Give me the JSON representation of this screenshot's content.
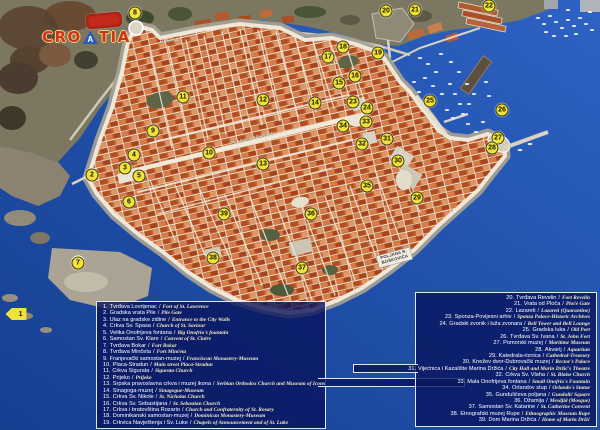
{
  "logo": {
    "text_pre": "CRO",
    "text_a": "A",
    "text_post": "TIA"
  },
  "ui": {
    "separator": "/"
  },
  "colors": {
    "sea_blue": "#2152ac",
    "roof_terracotta": "#c2602e",
    "marker_yellow": "#f0e13c",
    "legend_navy": "#09145e",
    "legend_english_text": "#f2e8c0",
    "wall_white": "#efe8d8"
  },
  "map": {
    "labels": [
      {
        "text": "PELINE",
        "x": 160,
        "y": 40,
        "rot": -6
      },
      {
        "text": "PLACA STRADUN",
        "x": 230,
        "y": 142,
        "rot": -13
      },
      {
        "text": "POLJANA R. BOŠKOVIĆA",
        "x": 378,
        "y": 256,
        "rot": -15,
        "cls": "sign"
      }
    ],
    "markers": [
      {
        "n": "1",
        "x": 16,
        "y": 314,
        "cls": "arrow"
      },
      {
        "n": "2",
        "x": 92,
        "y": 175
      },
      {
        "n": "3",
        "x": 125,
        "y": 168
      },
      {
        "n": "4",
        "x": 134,
        "y": 155
      },
      {
        "n": "5",
        "x": 139,
        "y": 176
      },
      {
        "n": "6",
        "x": 129,
        "y": 202
      },
      {
        "n": "7",
        "x": 78,
        "y": 263
      },
      {
        "n": "8",
        "x": 135,
        "y": 13
      },
      {
        "n": "9",
        "x": 153,
        "y": 131
      },
      {
        "n": "10",
        "x": 209,
        "y": 153
      },
      {
        "n": "11",
        "x": 183,
        "y": 97
      },
      {
        "n": "12",
        "x": 263,
        "y": 100
      },
      {
        "n": "13",
        "x": 263,
        "y": 164
      },
      {
        "n": "14",
        "x": 315,
        "y": 103
      },
      {
        "n": "15",
        "x": 339,
        "y": 83
      },
      {
        "n": "16",
        "x": 355,
        "y": 76
      },
      {
        "n": "17",
        "x": 328,
        "y": 57
      },
      {
        "n": "18",
        "x": 343,
        "y": 47
      },
      {
        "n": "19",
        "x": 378,
        "y": 53
      },
      {
        "n": "20",
        "x": 386,
        "y": 11
      },
      {
        "n": "21",
        "x": 415,
        "y": 10
      },
      {
        "n": "22",
        "x": 489,
        "y": 6
      },
      {
        "n": "23",
        "x": 353,
        "y": 102
      },
      {
        "n": "24",
        "x": 367,
        "y": 108
      },
      {
        "n": "25",
        "x": 430,
        "y": 101
      },
      {
        "n": "26",
        "x": 502,
        "y": 110
      },
      {
        "n": "27",
        "x": 498,
        "y": 138
      },
      {
        "n": "28",
        "x": 492,
        "y": 148
      },
      {
        "n": "29",
        "x": 417,
        "y": 198
      },
      {
        "n": "30",
        "x": 398,
        "y": 161
      },
      {
        "n": "31",
        "x": 387,
        "y": 139
      },
      {
        "n": "32",
        "x": 362,
        "y": 144
      },
      {
        "n": "33",
        "x": 366,
        "y": 122
      },
      {
        "n": "34",
        "x": 343,
        "y": 126
      },
      {
        "n": "35",
        "x": 367,
        "y": 186
      },
      {
        "n": "36",
        "x": 311,
        "y": 214
      },
      {
        "n": "37",
        "x": 302,
        "y": 268
      },
      {
        "n": "38",
        "x": 213,
        "y": 258
      },
      {
        "n": "39",
        "x": 224,
        "y": 214
      }
    ]
  },
  "legend_left": {
    "items": [
      {
        "num": "1.",
        "hr": "Tvrđava Lovrijenac",
        "en": "Fort of St. Lawrence"
      },
      {
        "num": "2.",
        "hr": "Gradska vrata Pile",
        "en": "Pile Gate"
      },
      {
        "num": "3.",
        "hr": "Ulaz na gradske zidine",
        "en": "Entrance to the City Walls"
      },
      {
        "num": "4.",
        "hr": "Crkva Sv. Spasa",
        "en": "Church of St. Saviour"
      },
      {
        "num": "5.",
        "hr": "Velika Onofrijeva fontana",
        "en": "Big Onofrio's fountain"
      },
      {
        "num": "6.",
        "hr": "Samostan Sv. Klare",
        "en": "Convent of St. Claire"
      },
      {
        "num": "7.",
        "hr": "Tvrđava Bokar",
        "en": "Fort Bokar"
      },
      {
        "num": "8.",
        "hr": "Tvrđava Minčeta",
        "en": "Fort Minčeta"
      },
      {
        "num": "9.",
        "hr": "Franjevački samostan-muzej",
        "en": "Franciscan Monastery-Museum"
      },
      {
        "num": "10.",
        "hr": "Placa-Stradun",
        "en": "Main street Placa-Stradun"
      },
      {
        "num": "11.",
        "hr": "Crkva Sigurata",
        "en": "Sigurata Church"
      },
      {
        "num": "12.",
        "hr": "Prijeko",
        "en": "Prijeko"
      },
      {
        "num": "13.",
        "hr": "Srpska pravoslavna crkva i muzej ikona",
        "en": "Serbian Orthodox Church and Museum of Icons"
      },
      {
        "num": "14.",
        "hr": "Sinagoga-muzej",
        "en": "Sinagogue-Museum"
      },
      {
        "num": "15.",
        "hr": "Crkva Sv. Nikole",
        "en": "St. Nicholas Church"
      },
      {
        "num": "16.",
        "hr": "Crkva Sv. Sebastijana",
        "en": "St. Sebastian Church"
      },
      {
        "num": "17.",
        "hr": "Crkva i bratovština Rozario",
        "en": "Church and Confraternity of St. Rosary"
      },
      {
        "num": "18.",
        "hr": "Dominikanski samostan-muzej",
        "en": "Dominican Monastery-Museum"
      },
      {
        "num": "19.",
        "hr": "Crkvica Navještenja i Sv. Luke",
        "en": "Chapels of Announcement and of St. Luke"
      }
    ]
  },
  "legend_right": {
    "items": [
      {
        "num": "20.",
        "hr": "Tvrđava Revelin",
        "en": "Fort Revelin"
      },
      {
        "num": "21.",
        "hr": "Vrata od Ploča",
        "en": "Ploče Gate"
      },
      {
        "num": "22.",
        "hr": "Lazareti",
        "en": "Lazareti (Quarantine)"
      },
      {
        "num": "23.",
        "hr": "Sponza-Povijesni arhiv",
        "en": "Sponza Palace-Historic Archives"
      },
      {
        "num": "24.",
        "hr": "Gradski zvonik i luža zvonara",
        "en": "Bell Tower and Bell Lounge"
      },
      {
        "num": "25.",
        "hr": "Gradska luka",
        "en": "Old Port"
      },
      {
        "num": "26.",
        "hr": "Tvrđava Sv. Ivana",
        "en": "St. John Fort"
      },
      {
        "num": "27.",
        "hr": "Pomorski muzej",
        "en": "Maritime Museum"
      },
      {
        "num": "28.",
        "hr": "Akvarij",
        "en": "Aquarium"
      },
      {
        "num": "29.",
        "hr": "Katedrala-riznica",
        "en": "Cathedral-Treasury"
      },
      {
        "num": "30.",
        "hr": "Knežev dvor-Dubrovački muzej",
        "en": "Rector's Palace"
      },
      {
        "num": "31.",
        "hr": "Vijećnica i Kazalište Marina Držića",
        "en": "City Hall and Marin Držić's Theatre"
      },
      {
        "num": "32.",
        "hr": "Crkva Sv. Vlaha",
        "en": "St. Blaise Church"
      },
      {
        "num": "33.",
        "hr": "Mala Onofrijeva fontana",
        "en": "Small Onofrio's Fountain"
      },
      {
        "num": "34.",
        "hr": "Orlandov stup",
        "en": "Orlando's Statue"
      },
      {
        "num": "35.",
        "hr": "Gundulićeva poljana",
        "en": "Gundulić Square"
      },
      {
        "num": "36.",
        "hr": "Džamija",
        "en": "Mesdjid (Mosque)"
      },
      {
        "num": "37.",
        "hr": "Samostan Sv. Katarine",
        "en": "St. Catherine Convent"
      },
      {
        "num": "38.",
        "hr": "Etnografski muzej Rupe",
        "en": "Ethnographic Museum Rupe"
      },
      {
        "num": "39.",
        "hr": "Dom Marina Držića",
        "en": "Home of Marin Držić"
      }
    ]
  }
}
